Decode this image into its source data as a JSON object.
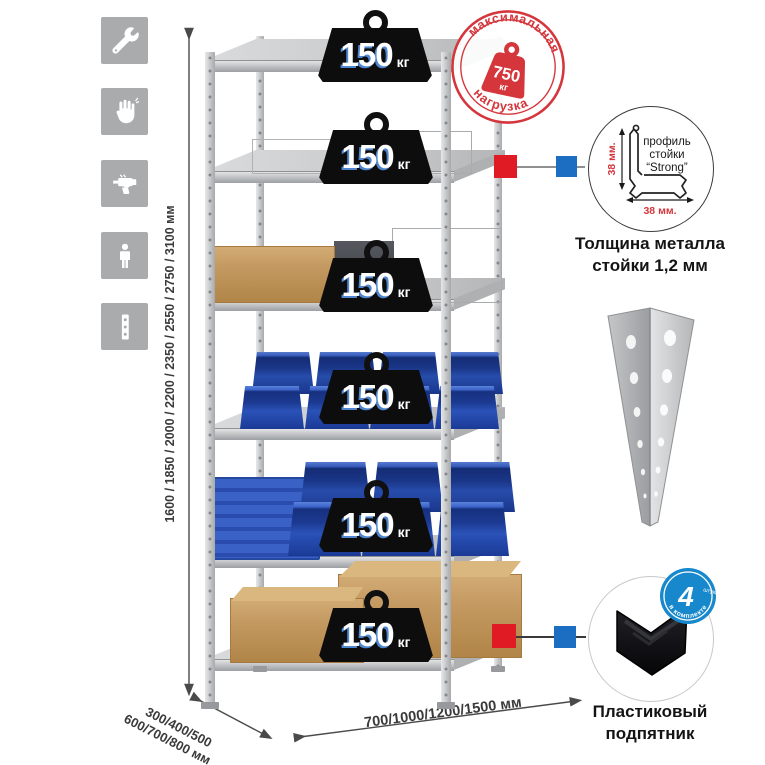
{
  "sidebar_icons": [
    {
      "name": "wrench"
    },
    {
      "name": "gloves"
    },
    {
      "name": "drill"
    },
    {
      "name": "person"
    },
    {
      "name": "post-profile"
    }
  ],
  "load_badges": {
    "unit": "кг",
    "items": [
      {
        "value": "150"
      },
      {
        "value": "150"
      },
      {
        "value": "150"
      },
      {
        "value": "150"
      },
      {
        "value": "150"
      },
      {
        "value": "150"
      }
    ]
  },
  "stamp": {
    "arc_top": "максимальная",
    "arc_bottom": "нагрузка",
    "value": "750",
    "unit": "кг"
  },
  "dimensions": {
    "height": "1600 / 1850 / 2000 / 2200 / 2350 / 2550 / 2750 / 3100 мм",
    "depth_line1": "300/400/500",
    "depth_line2": "600/700/800 мм",
    "width": "700/1000/1200/1500 мм"
  },
  "profile_callout": {
    "label_line1": "профиль",
    "label_line2": "стойки",
    "label_line3": "“Strong”",
    "dim_vertical": "38 мм.",
    "dim_horizontal": "38 мм.",
    "caption_line1": "Толщина металла",
    "caption_line2": "стойки 1,2 мм"
  },
  "foot_callout": {
    "badge_value": "4",
    "badge_qty": "штуки",
    "badge_arc": "в комплекте",
    "caption_line1": "Пластиковый",
    "caption_line2": "подпятник"
  },
  "colors": {
    "accent_red": "#d4363c",
    "marker_red": "#e01b24",
    "marker_blue": "#1b6ec2",
    "badge_blue": "#1888cc",
    "bin_blue": "#2a52b8",
    "rack_gray": "#c6c8ca"
  }
}
